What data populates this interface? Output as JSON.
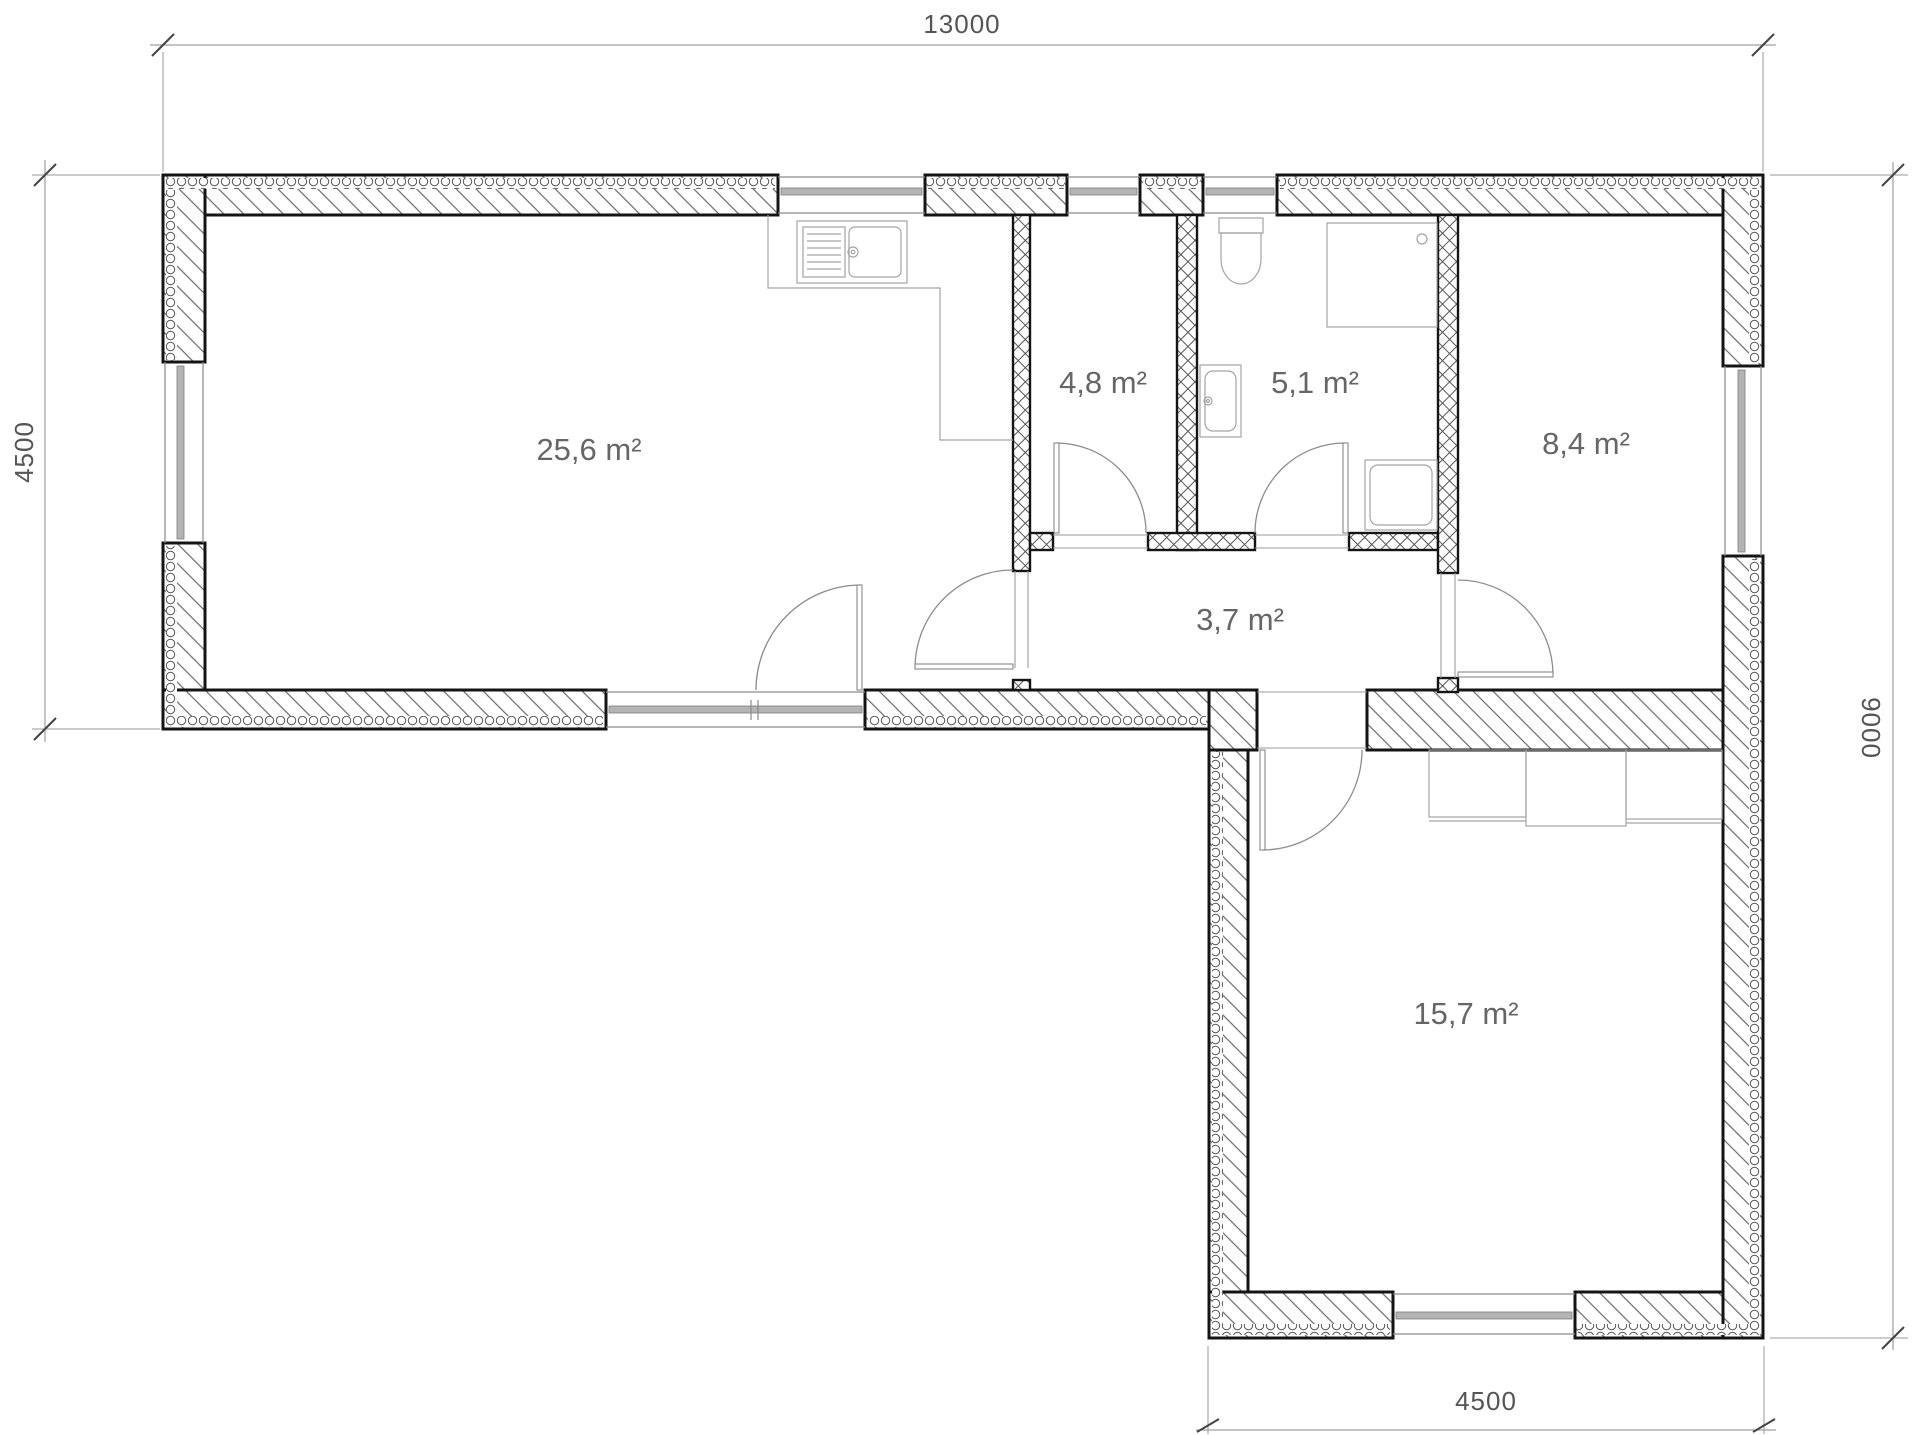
{
  "rooms": {
    "living": {
      "label": "25,6 m²"
    },
    "wc": {
      "label": "4,8 m²"
    },
    "bathroom": {
      "label": "5,1 m²"
    },
    "small_bedroom": {
      "label": "8,4 m²"
    },
    "hallway": {
      "label": "3,7 m²"
    },
    "bedroom": {
      "label": "15,7 m²"
    }
  },
  "dimensions": {
    "top": "13000",
    "left": "4500",
    "right": "9000",
    "bottom_right": "4500"
  },
  "fixtures": [
    "kitchen-counter",
    "kitchen-sink",
    "toilet",
    "washbasin",
    "shower",
    "washing-machine",
    "wardrobe"
  ],
  "colors": {
    "wall_outline": "#141414",
    "wall_hatch": "#6a6a6a",
    "glazing_bar": "#b4b4b4",
    "dimension_text": "#555555",
    "room_label_text": "#666666"
  }
}
